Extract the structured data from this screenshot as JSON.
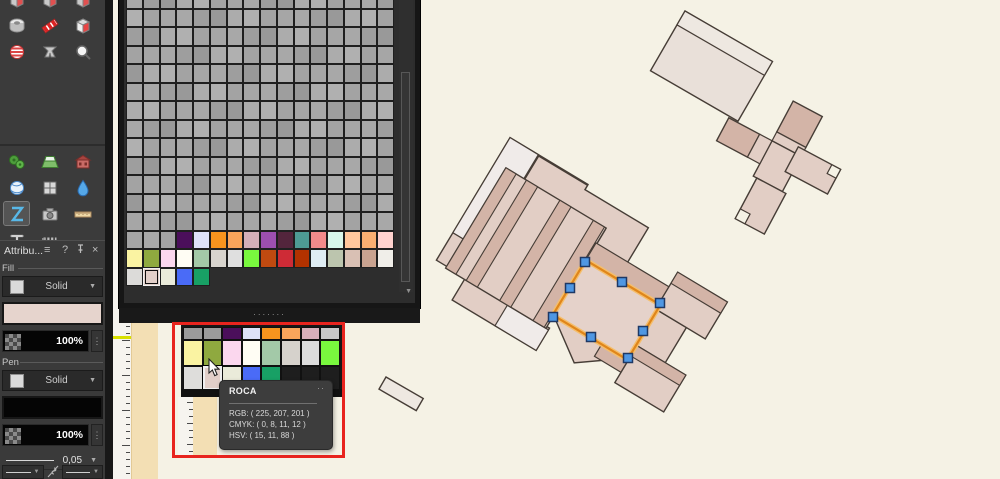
{
  "sidebar": {
    "groups": [
      [
        [
          "cube-icon",
          "cube-icon",
          "cube-icon"
        ],
        [
          "tape-roll-icon",
          "ribbon-icon",
          "cube-red-icon"
        ],
        [
          "sphere-icon",
          "clamp-icon",
          "zoom-search-icon"
        ]
      ],
      [
        [
          "gears-icon",
          "terrain-icon",
          "building-icon"
        ],
        [
          "globe-icon",
          "layout-grid-icon",
          "droplet-icon"
        ],
        [
          "z-tool-icon",
          "camera-icon",
          "ruler-icon"
        ],
        [
          "beam-icon",
          "zipper-icon"
        ]
      ]
    ],
    "selected_tool": "z-tool-icon"
  },
  "attributes_panel": {
    "title": "Attribu...",
    "menu_icon": "≡",
    "help_icon": "?",
    "close_icon": "×",
    "fill": {
      "label": "Fill",
      "style": "Solid",
      "color": "#E6D4CD",
      "opacity": "100%",
      "kebab": "⋮"
    },
    "pen": {
      "label": "Pen",
      "style": "Solid",
      "color": "#050505",
      "opacity": "100%",
      "kebab": "⋮",
      "width": "0,05"
    },
    "caret": "▼"
  },
  "palette_panel": {
    "gray_variants": [
      "#A8A8A8",
      "#A3A3A3",
      "#ACACAC",
      "#9E9E9E",
      "#A6A6A6",
      "#B0B0B0",
      "#999999"
    ],
    "gray_rows": 13,
    "cols": 16,
    "color_row_1": [
      "#A6A6A6",
      "#A9A9A9",
      "#A4A4A4",
      "#4B0F5B",
      "#DEE2F8",
      "#F7941E",
      "#F9A55B",
      "#D4AFB8",
      "#9C4FAE",
      "#53253C",
      "#4E9B94",
      "#F28B8B",
      "#D9F8EC",
      "#FFC79D",
      "#F8AE71",
      "#FFD2CE"
    ],
    "color_row_2": [
      "#FAF3A2",
      "#8FA93F",
      "#FBD7EE",
      "#FFFDF4",
      "#A3C9A8",
      "#D8D4CE",
      "#DFDFDF",
      "#79F83E",
      "#C04A10",
      "#CE2B36",
      "#B23200",
      "#DFEDF4",
      "#BCC5AE",
      "#D9C0B4",
      "#C9A390",
      "#F0EEE9"
    ],
    "color_row_3": [
      "#DCDBD9",
      "#E2CFC9",
      "#EAEBDA",
      "#4A6BF7",
      "#18A065"
    ],
    "selected_row3_index": 1,
    "scroll_arrow": "▼",
    "dots_handle": "·······"
  },
  "ruler": {
    "label_top": "6661050",
    "label_bottom": "6661000",
    "marker_color": "#D8E000"
  },
  "inset": {
    "row_top": [
      "#9B9B9B",
      "#9B9B9B",
      "#4B0F5B",
      "#DEE2F8",
      "#F7941E",
      "#F9A55B",
      "#D8AFBA",
      "#C9C9C9"
    ],
    "row_mid": [
      "#FAF3A2",
      "#8FA93F",
      "#FBD7EE",
      "#FFFDF4",
      "#A3C9A8",
      "#D6D2CC",
      "#DCDCDC",
      "#79F83E"
    ],
    "row_bottom": [
      "#DEDDDB",
      "#E2CFC9",
      "#EAEBDA",
      "#4A6BF7",
      "#18A065",
      "#1E1E1E",
      "#1E1E1E",
      "#1E1E1E"
    ],
    "selected_index": 1,
    "ruler_label": "6661050",
    "tooltip": {
      "title": "ROCA",
      "more": "··",
      "rgb": "RGB: ( 225, 207, 201 )",
      "cmyk": "CMYK: ( 0, 8, 11, 12 )",
      "hsv": "HSV: ( 15, 11, 88 )"
    }
  },
  "canvas": {
    "bg": "#F5F2E5",
    "paper_band": "#F3DFB4",
    "outline": "#463D36",
    "building_light": "#E2CEC5",
    "building_dark": "#D3B4A7",
    "building_white": "#F0EBE9",
    "building_pale": "#E9E0D9",
    "building_pale_band": "#EEE8E1",
    "room_fill": "#E5D2CA",
    "selection_orange": "#E0861A",
    "selection_glow": "#F5BE6B",
    "handle_fill": "#4F97E3",
    "handle_stroke": "#1F3864"
  }
}
